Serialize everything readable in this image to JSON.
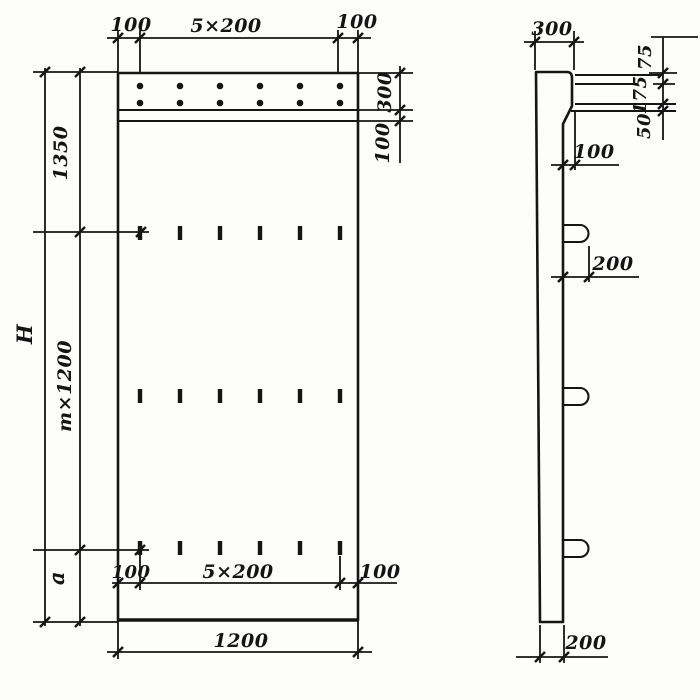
{
  "front_view": {
    "dim_top_left": "100",
    "dim_top_span": "5×200",
    "dim_top_right": "100",
    "dim_strip_height": "300",
    "dim_strip_band": "100",
    "dim_upper": "1350",
    "dim_total_height": "H",
    "dim_module": "m×1200",
    "dim_bottom_gap": "a",
    "dim_bot_left": "100",
    "dim_bot_span": "5×200",
    "dim_bot_right": "100",
    "dim_width": "1200"
  },
  "side_view": {
    "dim_top_width": "300",
    "dim_ledge_top": "75",
    "dim_ledge_mid": "175",
    "dim_ledge_bottom": "50",
    "dim_step": "100",
    "dim_hook": "200",
    "dim_bottom_width": "200"
  }
}
